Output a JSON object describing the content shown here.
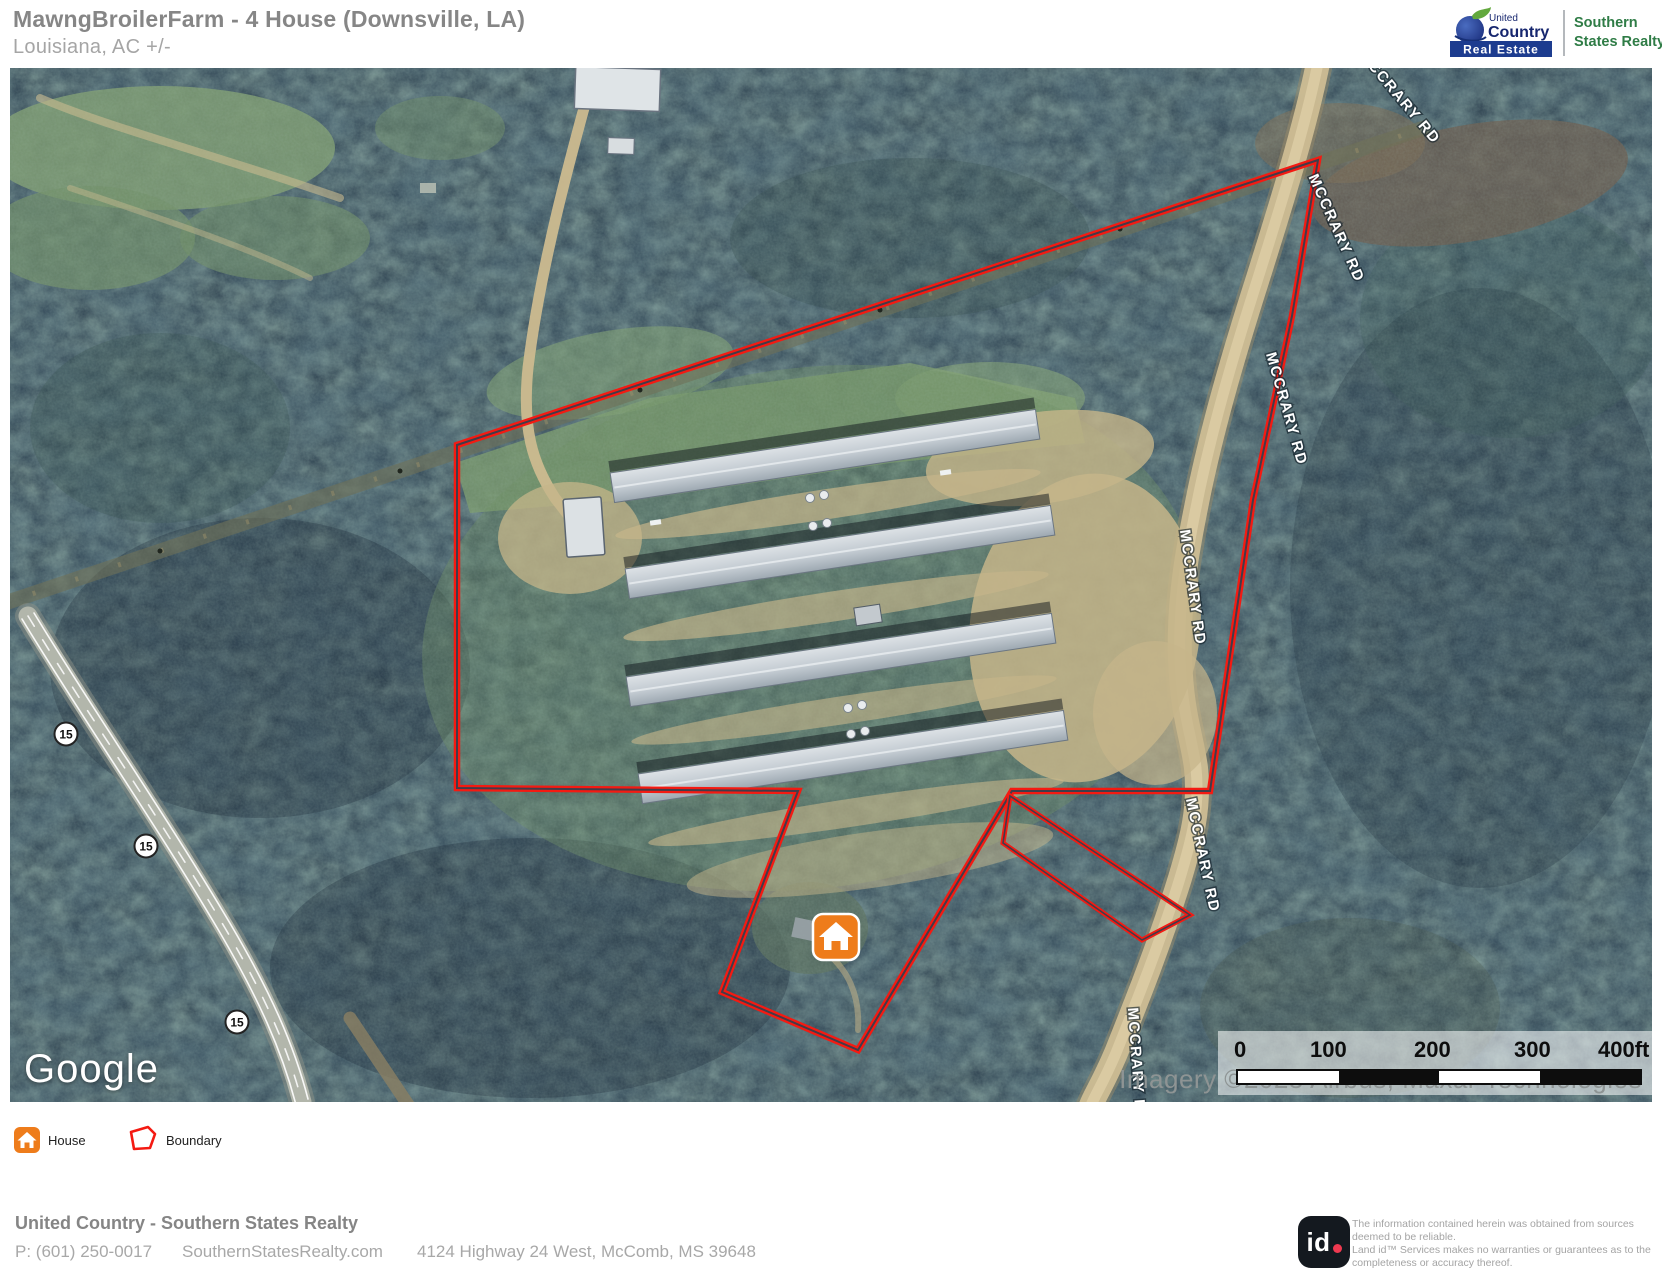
{
  "header": {
    "title": "MawngBroilerFarm - 4 House (Downsville, LA)",
    "subtitle": "Louisiana,  AC +/-",
    "brand": {
      "united": "United",
      "country": "Country",
      "real_estate": "Real Estate",
      "line1": "Southern",
      "line2": "States Realty"
    }
  },
  "map": {
    "road_label": "MCCRARY RD",
    "shield": "15",
    "google": "Google",
    "attribution": "Imagery ©2025 Airbus, Maxar Technologies",
    "scale": {
      "labels": [
        "0",
        "100",
        "200",
        "300",
        "400ft"
      ]
    }
  },
  "legend": {
    "house_label": "House",
    "boundary_label": "Boundary"
  },
  "footer": {
    "company": "United Country - Southern States Realty",
    "phone": "P: (601) 250-0017",
    "website": "SouthernStatesRealty.com",
    "address": "4124 Highway 24 West, McComb, MS 39648",
    "id_text": "id",
    "disclaimer1": "The information contained herein was obtained from sources deemed to be reliable.",
    "disclaimer2": " Land id™ Services makes no warranties or guarantees as to the completeness or accuracy thereof."
  },
  "colors": {
    "boundary_red": "#f41a12",
    "marker_orange": "#ee7c1b",
    "brand_navy": "#1d3c8f",
    "brand_green": "#2f7c46"
  }
}
